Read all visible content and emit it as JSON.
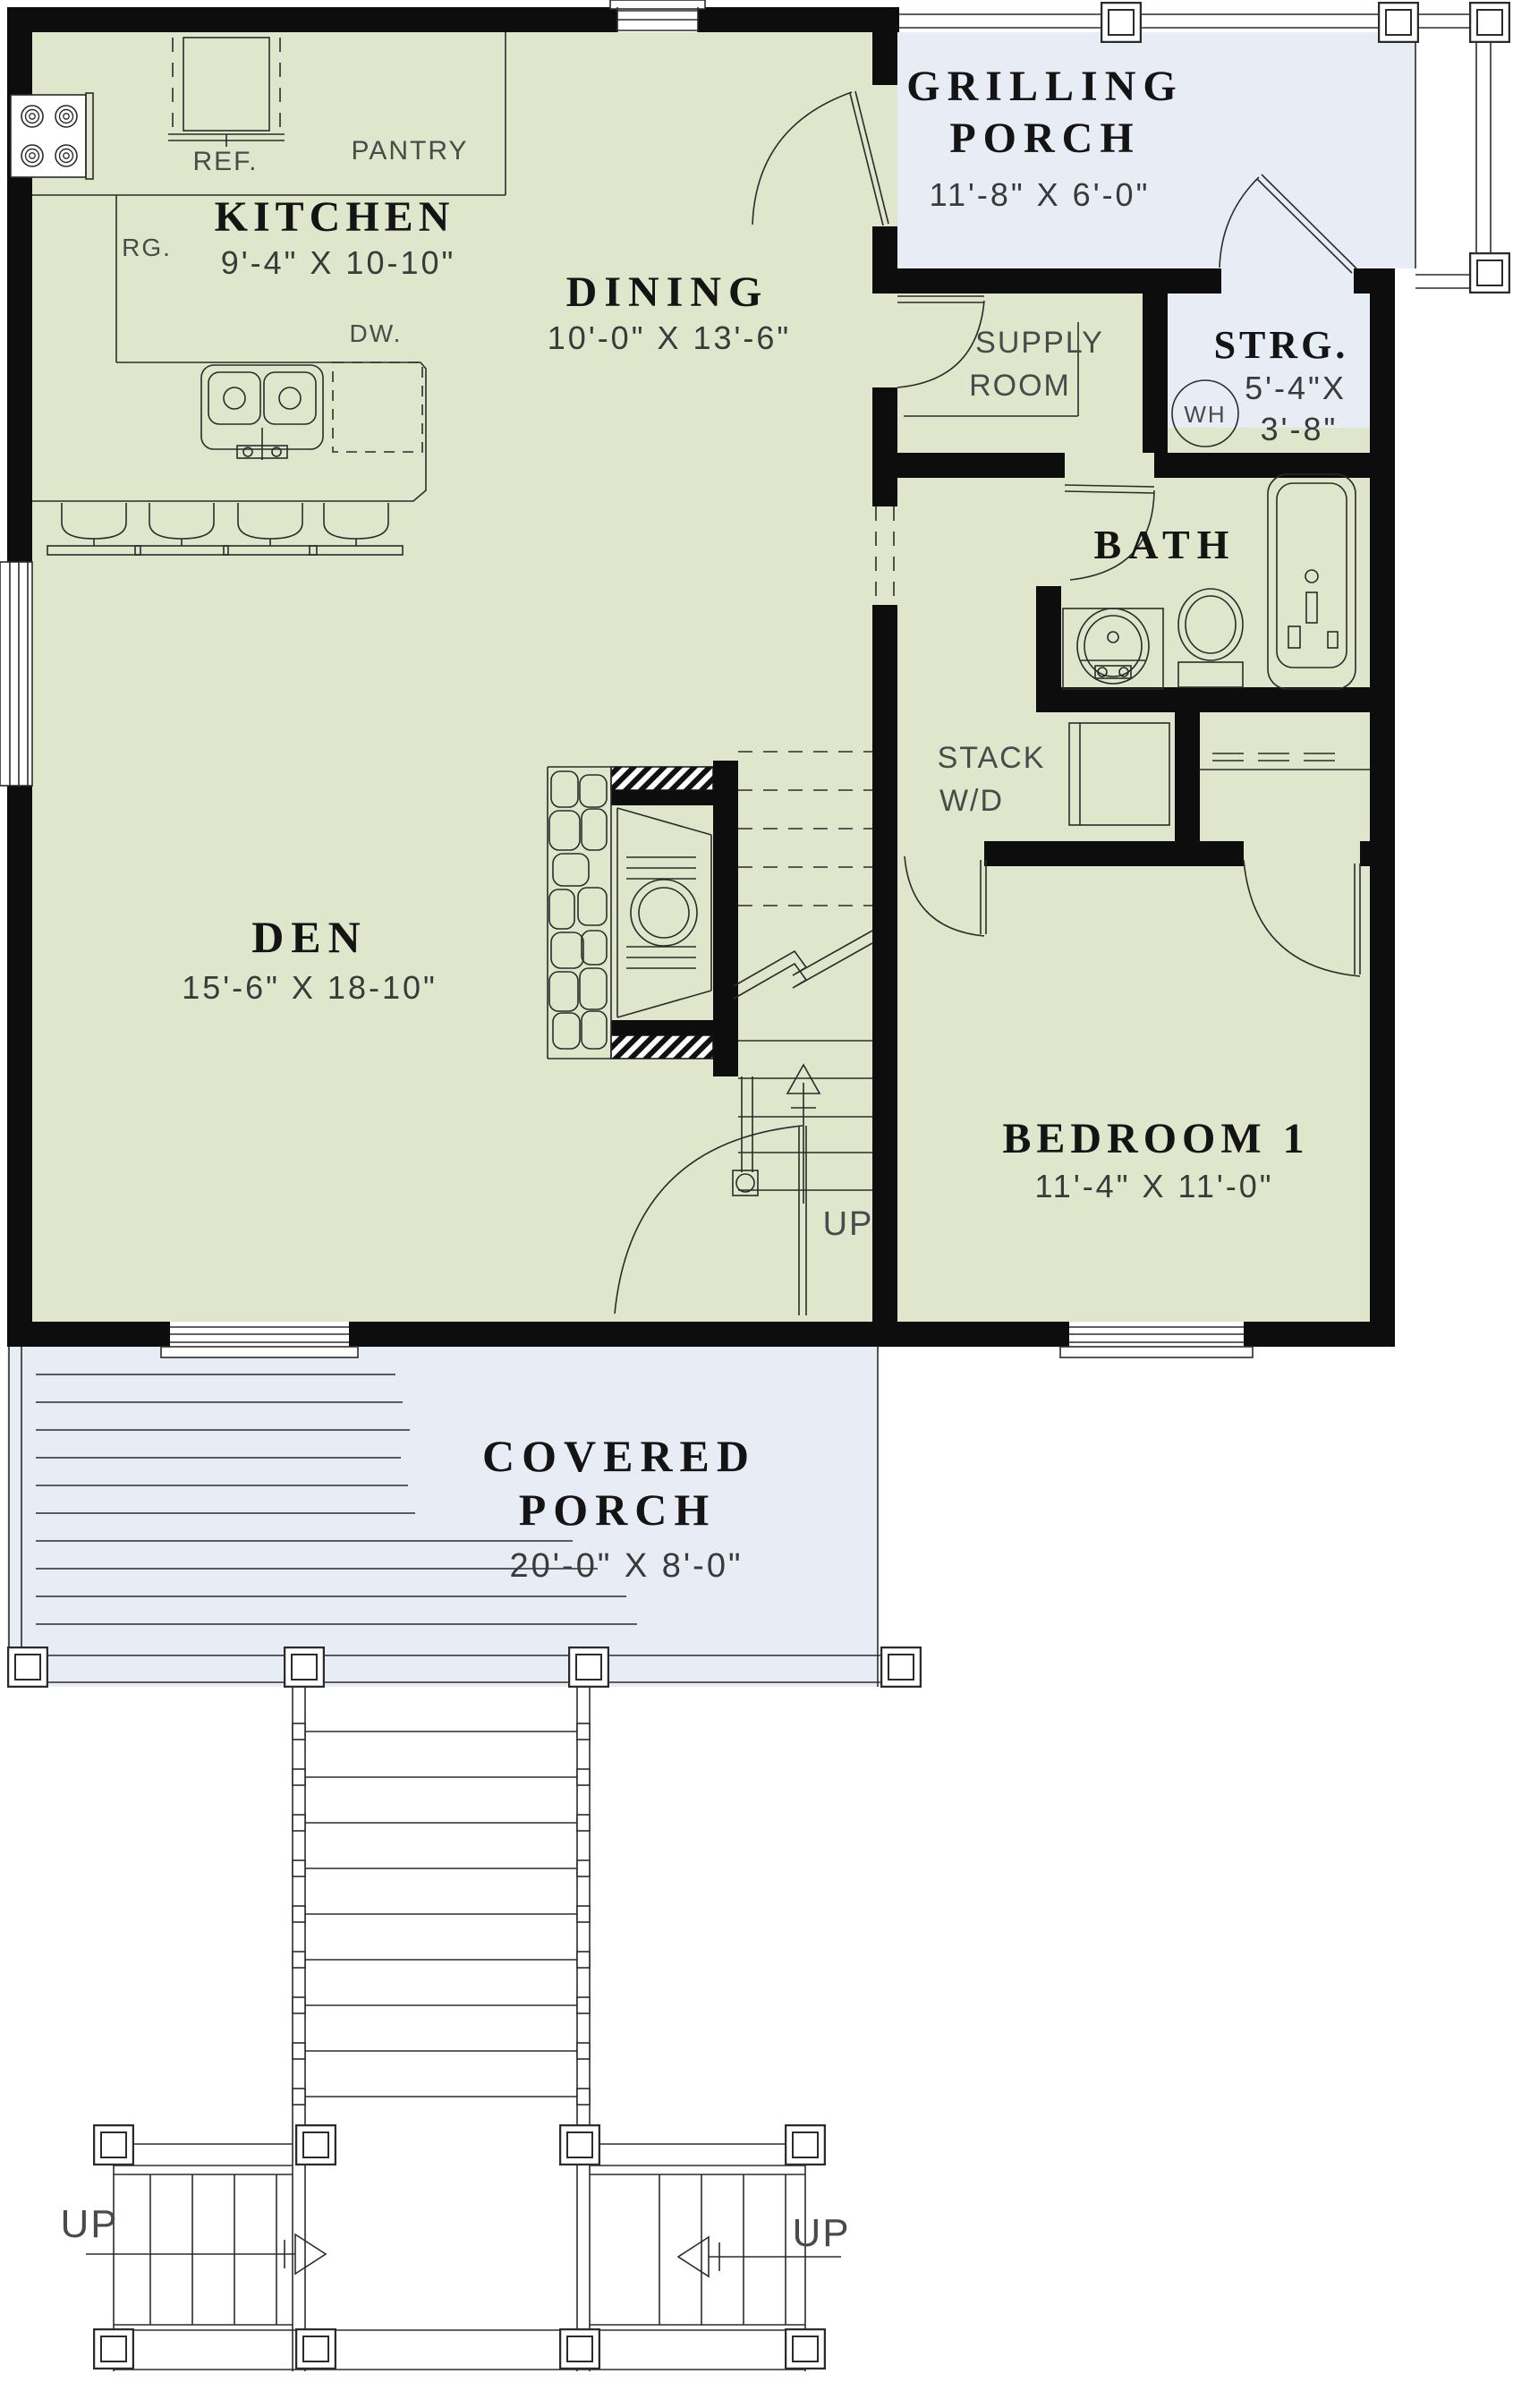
{
  "plan": {
    "colors": {
      "room_fill": "#dfe6cb",
      "porch_fill": "#e7ecf5",
      "wall": "#0d0d0d",
      "line": "#2b2b2b"
    },
    "rooms": {
      "grilling_porch": {
        "line1": "GRILLING",
        "line2": "PORCH",
        "dims": "11'-8\" X 6'-0\""
      },
      "storage": {
        "name": "STRG.",
        "dims1": "5'-4\"X",
        "dims2": "3'-8\""
      },
      "supply": {
        "line1": "SUPPLY",
        "line2": "ROOM"
      },
      "bath": {
        "name": "BATH"
      },
      "laundry": {
        "line1": "STACK",
        "line2": "W/D"
      },
      "kitchen": {
        "name": "KITCHEN",
        "dims": "9'-4\" X 10-10\""
      },
      "dining": {
        "name": "DINING",
        "dims": "10'-0\" X 13'-6\""
      },
      "den": {
        "name": "DEN",
        "dims": "15'-6\" X 18-10\""
      },
      "bedroom1": {
        "name": "BEDROOM 1",
        "dims": "11'-4\" X 11'-0\""
      },
      "covered_porch": {
        "line1": "COVERED",
        "line2": "PORCH",
        "dims": "20'-0\" X 8'-0\""
      }
    },
    "labels": {
      "refrigerator": "REF.",
      "pantry": "PANTRY",
      "range": "RG.",
      "dishwasher": "DW.",
      "water_heater": "WH",
      "stair_up": "UP",
      "deck_up_left": "UP",
      "deck_up_right": "UP"
    }
  }
}
